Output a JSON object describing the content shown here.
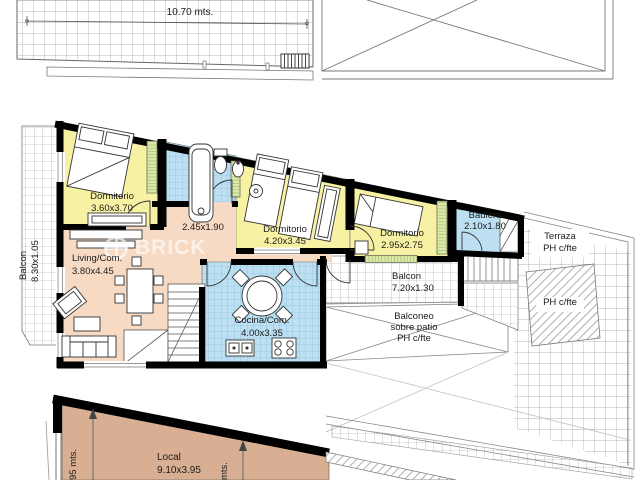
{
  "brand": {
    "watermark": "BRICK"
  },
  "roof_plan": {
    "width_dim": "10.70 mts."
  },
  "main_plan": {
    "balcon_left": {
      "name": "Balcon",
      "size": "8.30x1.05"
    },
    "dormitorio_1": {
      "name": "Dormitorio",
      "size": "3.60x3.70"
    },
    "hall": {
      "size": "2.45x1.90"
    },
    "dormitorio_2": {
      "name": "Dormitorio",
      "size": "4.20x3.45"
    },
    "dormitorio_3": {
      "name": "Dormitorio",
      "size": "2.95x2.75"
    },
    "baulera": {
      "name": "Baulera",
      "size": "2.10x1.80"
    },
    "living": {
      "name": "Living/Com.",
      "size": "3.80x4.45"
    },
    "cocina": {
      "name": "Cocina/Com.",
      "size": "4.00x3.35"
    },
    "balcon_right": {
      "name": "Balcon",
      "size": "7.20x1.30"
    },
    "balconeo": {
      "line1": "Balconeo",
      "line2": "sobre patio",
      "line3": "PH c/fte"
    },
    "terraza": {
      "line1": "Terraza",
      "line2": "PH c/fte"
    },
    "ph_area": {
      "label": "PH c/fte"
    }
  },
  "ground_plan": {
    "local": {
      "name": "Local",
      "size": "9.10x3.95"
    },
    "dim_left": "95 mts.",
    "dim_mid": "mts."
  },
  "colors": {
    "bedroom": "#F6F1A3",
    "wet": "#BCE0F2",
    "hall": "#F7DAC3",
    "local": "#D8AF93",
    "wall": "#000000",
    "grid": "#9B9B9B"
  }
}
